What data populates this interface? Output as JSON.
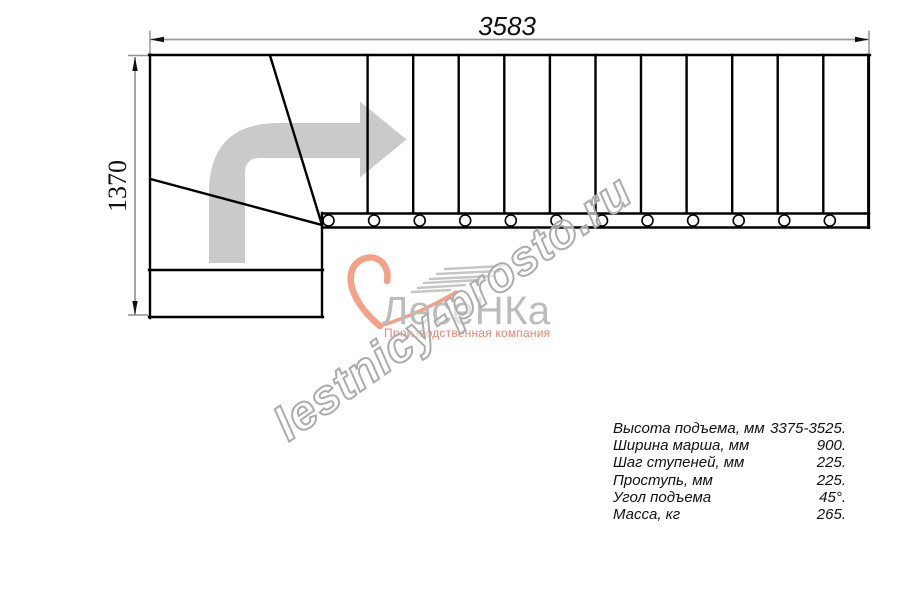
{
  "drawing": {
    "dim_width": "3583",
    "dim_height": "1370"
  },
  "watermark": {
    "text": "lestnicy-prosto.ru"
  },
  "logo": {
    "name": "ЛесеНКа",
    "tagline": "Производственная компания"
  },
  "specs": {
    "rows": [
      {
        "label": "Высота подъема, мм",
        "value": "3375-3525."
      },
      {
        "label": "Ширина марша, мм",
        "value": "900."
      },
      {
        "label": "Шаг ступеней, мм",
        "value": "225."
      },
      {
        "label": "Проступь, мм",
        "value": "225."
      },
      {
        "label": "Угол подъема",
        "value": "45°."
      },
      {
        "label": "Масса, кг",
        "value": "265."
      }
    ]
  },
  "colors": {
    "brand_accent": "#F4A189",
    "logo_text_gray": "#BCBCBC",
    "arrow_gray": "#CACACA",
    "watermark_outline": "#ACACAC"
  }
}
